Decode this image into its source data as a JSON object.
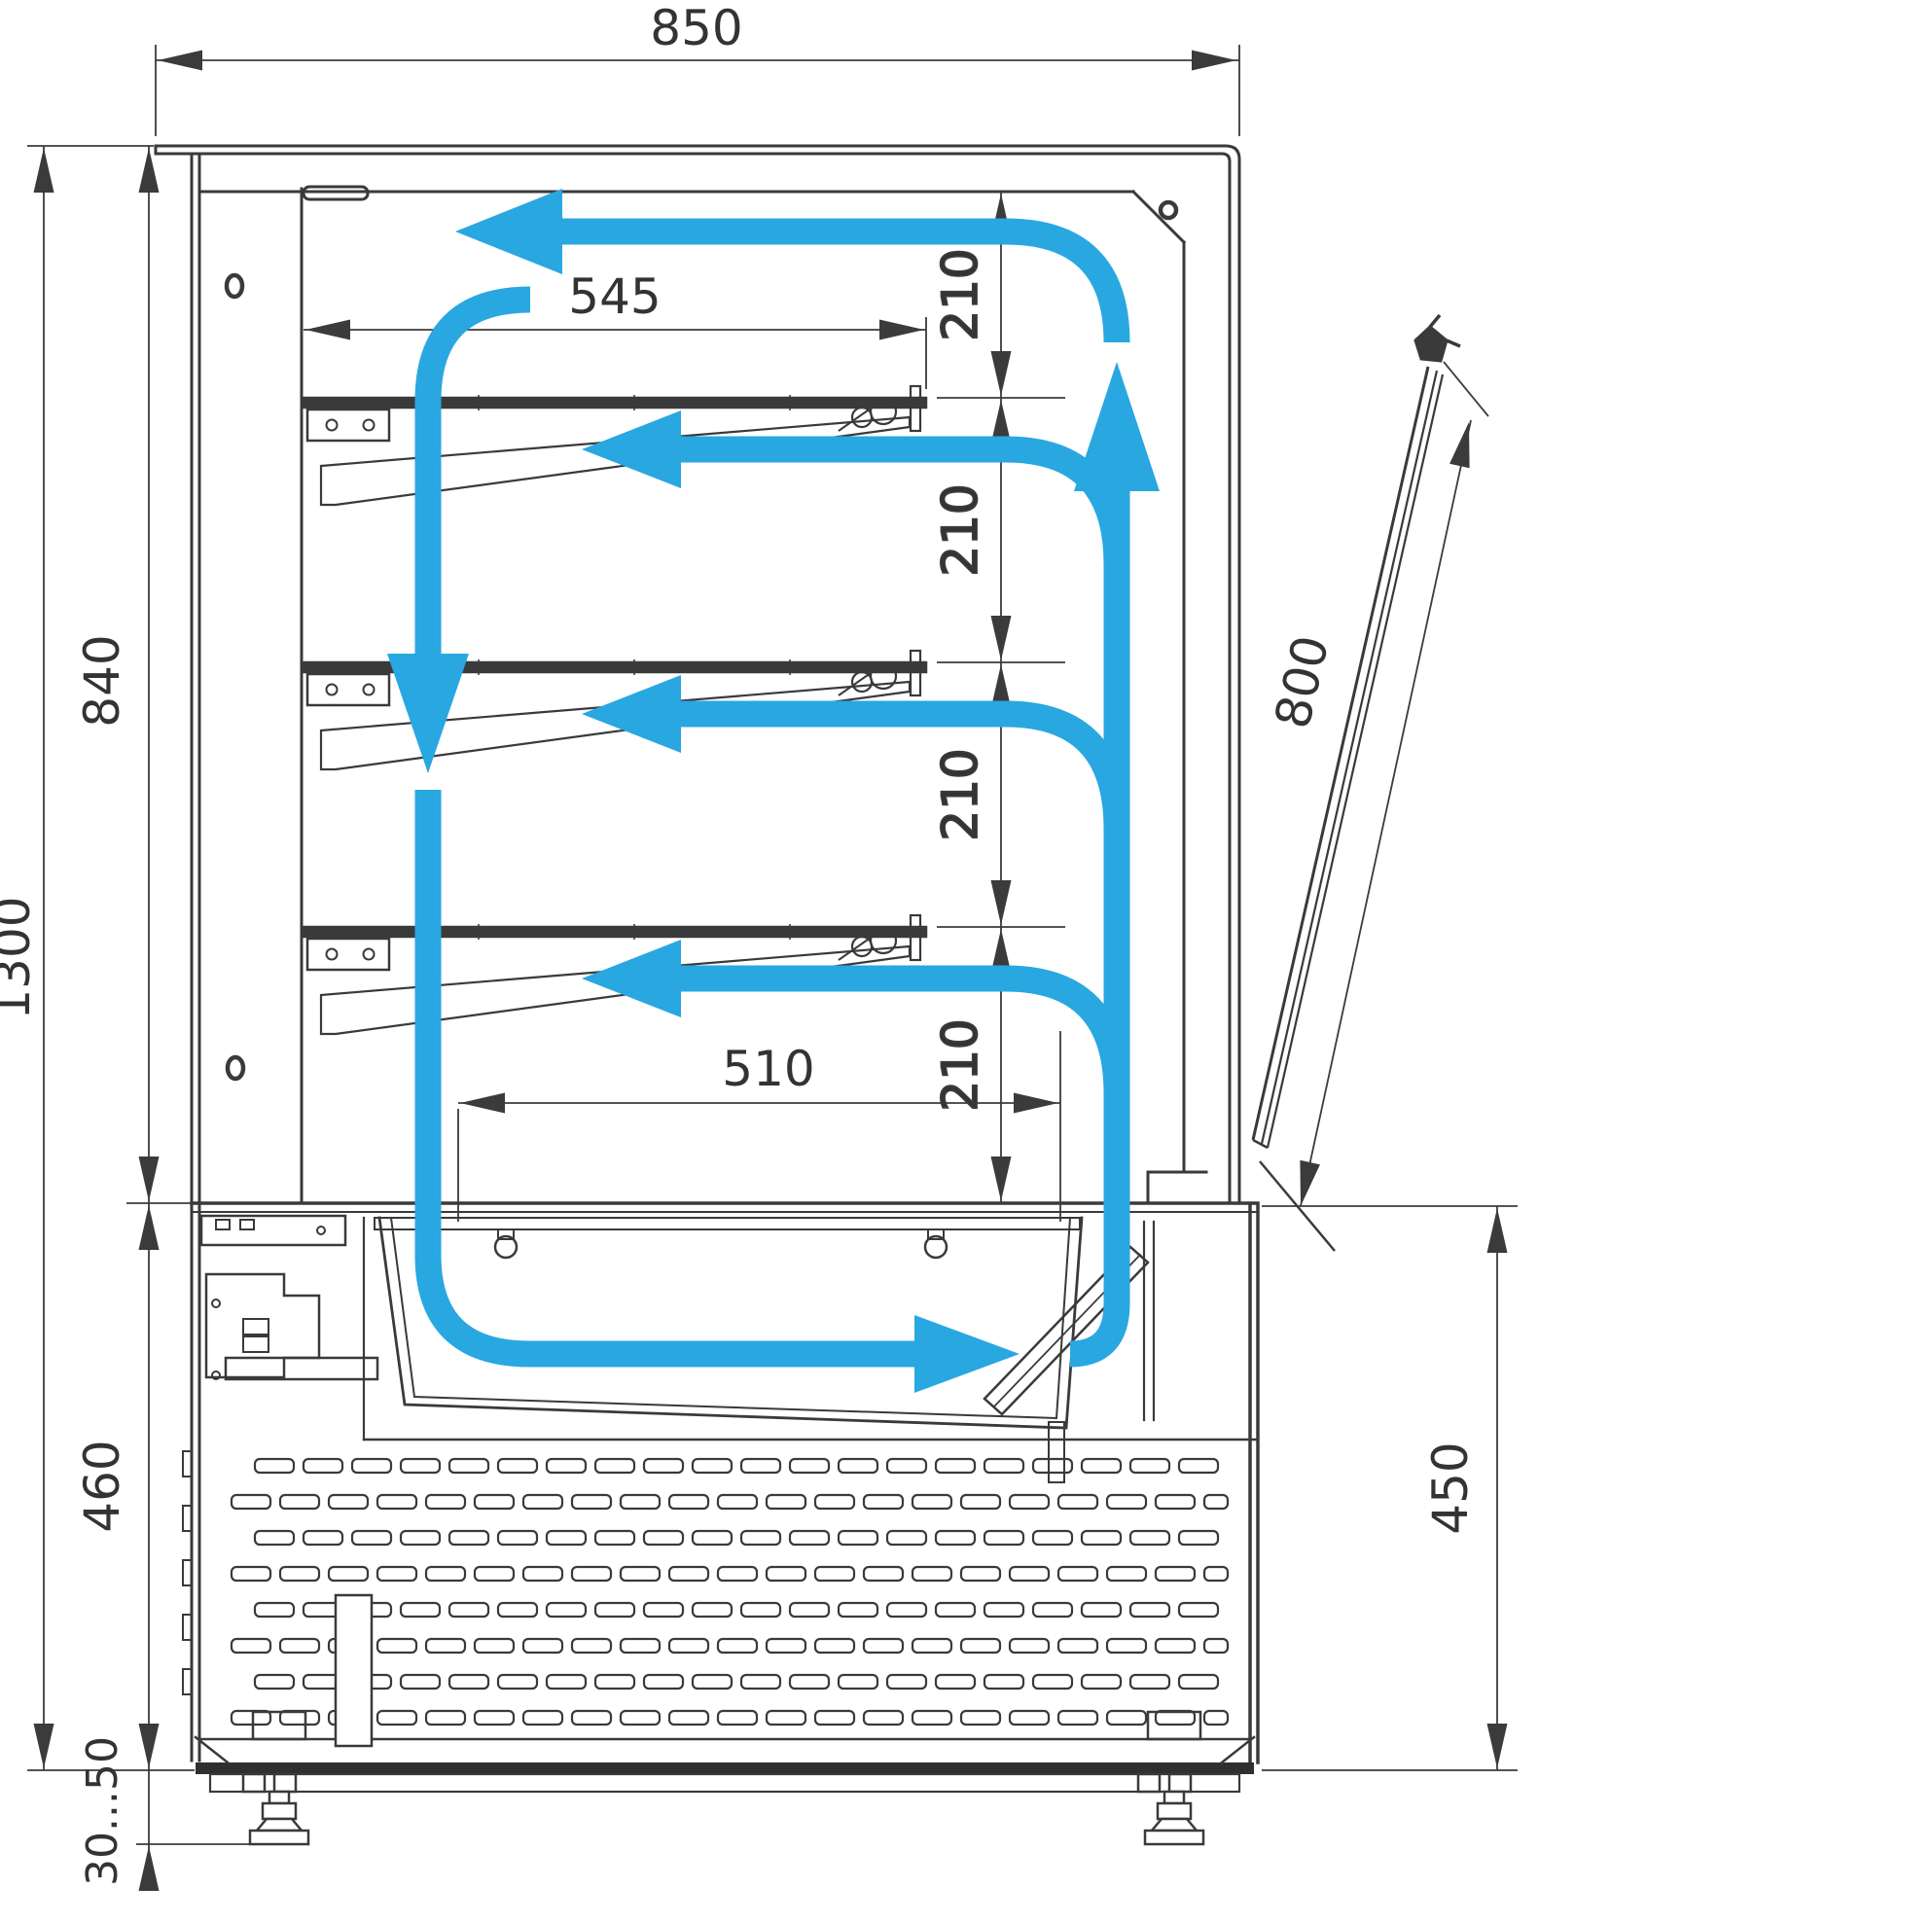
{
  "drawing": {
    "dims": {
      "top_width": "850",
      "shelf_depth": "545",
      "shelf_gap": "210",
      "upper_height": "840",
      "total_height": "1300",
      "lower_height": "460",
      "foot_adjust": "30...50",
      "deck_depth": "510",
      "door_length": "800",
      "front_height": "450"
    },
    "colors": {
      "airflow": "#29A7E1",
      "line": "#3a3a3a",
      "dimension": "#3b3b3b",
      "text": "#333333"
    },
    "icons": {
      "airflow_arrow": "blue-circulation-arrow",
      "hole_mark": "mounting-hole",
      "adjustable_foot": "leveling-foot"
    }
  }
}
